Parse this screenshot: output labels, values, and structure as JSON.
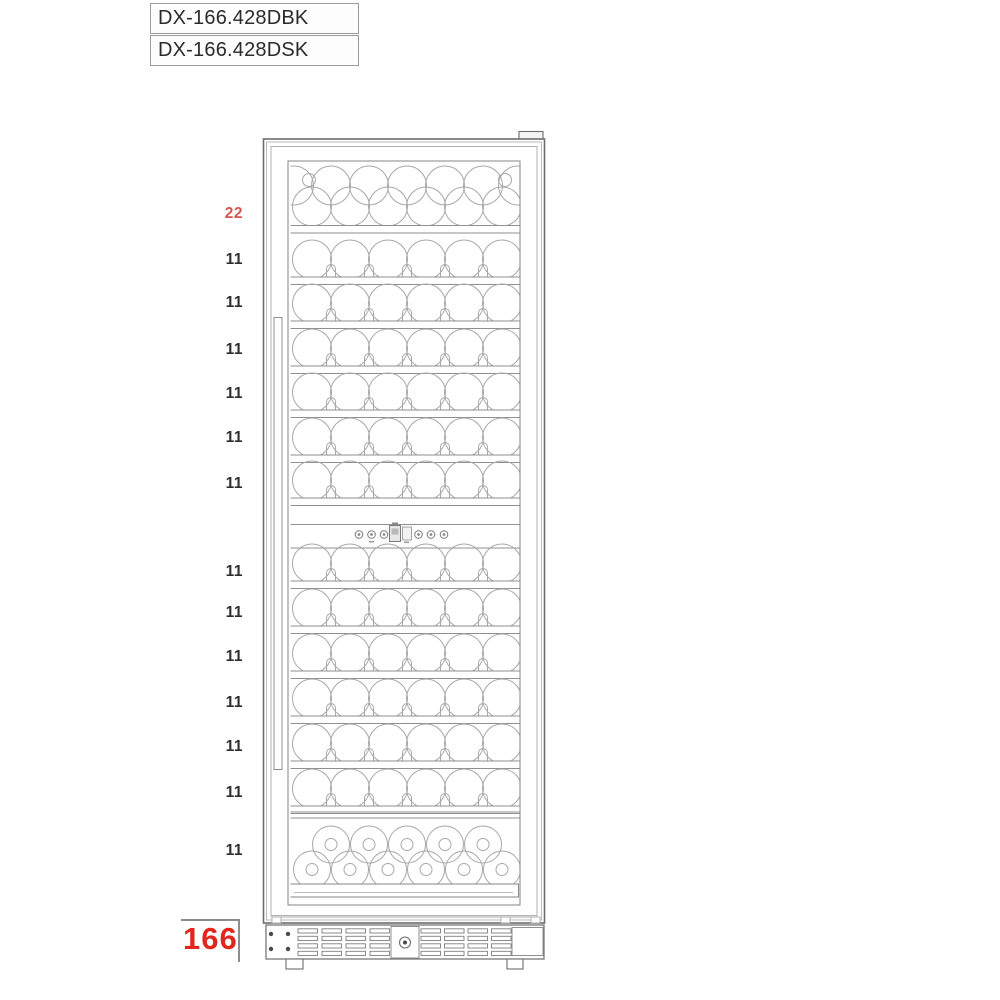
{
  "models": [
    {
      "name": "DX-166.428DBK"
    },
    {
      "name": "DX-166.428DSK"
    }
  ],
  "capacity_labels": [
    {
      "text": "22",
      "y": 214,
      "red": true
    },
    {
      "text": "11",
      "y": 260,
      "red": false
    },
    {
      "text": "11",
      "y": 303,
      "red": false
    },
    {
      "text": "11",
      "y": 350,
      "red": false
    },
    {
      "text": "11",
      "y": 394,
      "red": false
    },
    {
      "text": "11",
      "y": 438,
      "red": false
    },
    {
      "text": "11",
      "y": 484,
      "red": false
    },
    {
      "text": "11",
      "y": 572,
      "red": false
    },
    {
      "text": "11",
      "y": 613,
      "red": false
    },
    {
      "text": "11",
      "y": 657,
      "red": false
    },
    {
      "text": "11",
      "y": 703,
      "red": false
    },
    {
      "text": "11",
      "y": 747,
      "red": false
    },
    {
      "text": "11",
      "y": 793,
      "red": false
    },
    {
      "text": "11",
      "y": 851,
      "red": false
    }
  ],
  "total": {
    "text": "166"
  },
  "colors": {
    "label_red": "#d9534f",
    "total_red": "#e2261d",
    "line_dark": "#6d6d6d",
    "line_mid": "#8f8f8f",
    "line_light": "#a8a8a8",
    "slat": "#7f7f7f",
    "dot": "#4a4a4a",
    "text": "#2a2a2a"
  },
  "cooler": {
    "zones": [
      {
        "name": "top-double-shelf",
        "front_bottles": 6,
        "back_bottles": 5,
        "capacity": "22"
      },
      {
        "name": "upper-shelves",
        "shelf_count": 6,
        "front_bottles": 6,
        "back_bottles": 5,
        "capacity_each": "11"
      },
      {
        "name": "control-panel",
        "round_buttons": 6,
        "display": true
      },
      {
        "name": "lower-shelves",
        "shelf_count": 6,
        "front_bottles": 6,
        "back_bottles": 5,
        "capacity_each": "11"
      },
      {
        "name": "bottom-standing-rack",
        "top_row": 5,
        "bottom_row": 6,
        "capacity": "11"
      }
    ]
  }
}
